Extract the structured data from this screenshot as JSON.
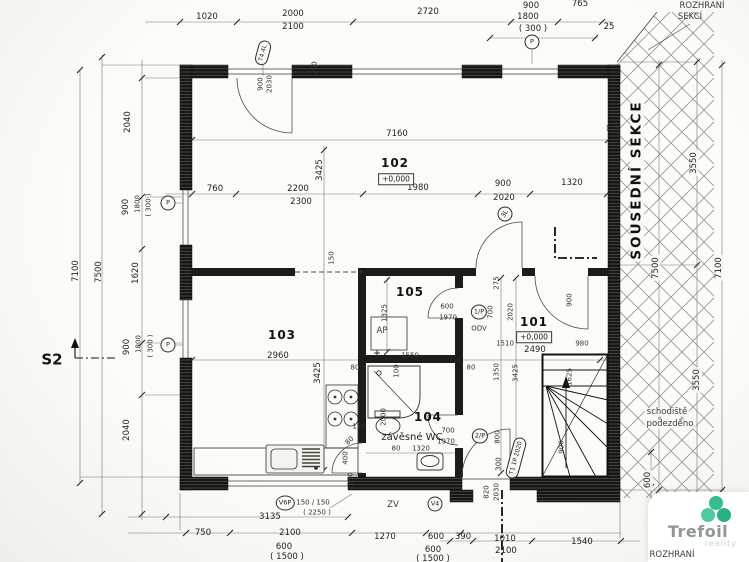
{
  "logo": {
    "name": "Trefoil",
    "tagline": "reality"
  },
  "rooms": [
    {
      "number": "102",
      "level": "+0,000",
      "x": 395,
      "y": 163,
      "lx": 396,
      "ly": 179
    },
    {
      "number": "103",
      "x": 282,
      "y": 335
    },
    {
      "number": "105",
      "x": 410,
      "y": 292
    },
    {
      "number": "104",
      "x": 428,
      "y": 417
    },
    {
      "number": "101",
      "level": "+0,000",
      "x": 534,
      "y": 322,
      "lx": 534,
      "ly": 337
    }
  ],
  "markers": [
    {
      "label": "P",
      "x": 532,
      "y": 42
    },
    {
      "label": "P",
      "x": 168,
      "y": 203
    },
    {
      "label": "P",
      "x": 168,
      "y": 345
    },
    {
      "label": "3L",
      "x": 505,
      "y": 214,
      "r": -60
    },
    {
      "label": "1/P",
      "x": 479,
      "y": 312
    },
    {
      "label": "2/P",
      "x": 480,
      "y": 436
    },
    {
      "label": "V6P",
      "x": 285,
      "y": 503
    },
    {
      "label": "V4",
      "x": 435,
      "y": 504
    },
    {
      "label": "T4.4L",
      "x": 263,
      "y": 53,
      "r": -75,
      "w": 1
    },
    {
      "label": "T1 1P 2020",
      "x": 516,
      "y": 458,
      "r": -75,
      "w": 1
    }
  ],
  "dim_labels": [
    {
      "t": "1020",
      "x": 207,
      "y": 17
    },
    {
      "t": "2000",
      "x": 293,
      "y": 14
    },
    {
      "t": "2100",
      "x": 293,
      "y": 27
    },
    {
      "t": "2720",
      "x": 428,
      "y": 12
    },
    {
      "t": "900",
      "x": 531,
      "y": 6
    },
    {
      "t": "765",
      "x": 580,
      "y": 4
    },
    {
      "t": "1800",
      "x": 528,
      "y": 17
    },
    {
      "t": "( 300 )",
      "x": 533,
      "y": 29
    },
    {
      "t": "25",
      "x": 609,
      "y": 27
    },
    {
      "t": "ROZHRANÍ",
      "x": 702,
      "y": 6,
      "c": "note"
    },
    {
      "t": "SEKCÍ",
      "x": 690,
      "y": 17,
      "c": "note"
    },
    {
      "t": "7160",
      "x": 397,
      "y": 134
    },
    {
      "t": "125",
      "x": 612,
      "y": 129,
      "c": "xs"
    },
    {
      "t": "3425",
      "x": 320,
      "y": 170,
      "r": -90
    },
    {
      "t": "900",
      "x": 261,
      "y": 84,
      "r": -90,
      "c": "xs"
    },
    {
      "t": "2030",
      "x": 270,
      "y": 84,
      "r": -90,
      "c": "xs"
    },
    {
      "t": "250",
      "x": 315,
      "y": 68,
      "r": -90,
      "c": "xs"
    },
    {
      "t": "760",
      "x": 215,
      "y": 189
    },
    {
      "t": "2200",
      "x": 298,
      "y": 189
    },
    {
      "t": "2300",
      "x": 301,
      "y": 202
    },
    {
      "t": "1980",
      "x": 418,
      "y": 188
    },
    {
      "t": "900",
      "x": 503,
      "y": 184
    },
    {
      "t": "2020",
      "x": 504,
      "y": 198
    },
    {
      "t": "1320",
      "x": 572,
      "y": 183
    },
    {
      "t": "150",
      "x": 332,
      "y": 258,
      "r": -90,
      "c": "xs"
    },
    {
      "t": "2960",
      "x": 278,
      "y": 356
    },
    {
      "t": "1325",
      "x": 385,
      "y": 313,
      "r": -90,
      "c": "xs"
    },
    {
      "t": "AP",
      "x": 382,
      "y": 331,
      "c": "note"
    },
    {
      "t": "600",
      "x": 447,
      "y": 307,
      "c": "xs"
    },
    {
      "t": "1970",
      "x": 448,
      "y": 318,
      "c": "xs"
    },
    {
      "t": "1550",
      "x": 410,
      "y": 356,
      "c": "xs"
    },
    {
      "t": "80",
      "x": 355,
      "y": 368,
      "c": "xs"
    },
    {
      "t": "100",
      "x": 397,
      "y": 371,
      "r": -90,
      "c": "xs"
    },
    {
      "t": "3425",
      "x": 318,
      "y": 373,
      "r": -90
    },
    {
      "t": "275",
      "x": 497,
      "y": 283,
      "r": -90,
      "c": "xs"
    },
    {
      "t": "700",
      "x": 491,
      "y": 312,
      "r": -90,
      "c": "xs"
    },
    {
      "t": "2020",
      "x": 511,
      "y": 312,
      "r": -90,
      "c": "xs"
    },
    {
      "t": "900",
      "x": 570,
      "y": 300,
      "r": -90,
      "c": "xs"
    },
    {
      "t": "ODV",
      "x": 479,
      "y": 329,
      "c": "xs"
    },
    {
      "t": "1510",
      "x": 505,
      "y": 344,
      "c": "xs"
    },
    {
      "t": "980",
      "x": 582,
      "y": 344,
      "c": "xs"
    },
    {
      "t": "2490",
      "x": 535,
      "y": 350
    },
    {
      "t": "1625",
      "x": 570,
      "y": 377,
      "r": -90,
      "c": "xs"
    },
    {
      "t": "1350",
      "x": 497,
      "y": 372,
      "r": -90,
      "c": "xs"
    },
    {
      "t": "3425",
      "x": 516,
      "y": 373,
      "r": -90,
      "c": "xs"
    },
    {
      "t": "80",
      "x": 471,
      "y": 368,
      "c": "xs"
    },
    {
      "t": "900",
      "x": 562,
      "y": 447,
      "r": -90,
      "c": "xs"
    },
    {
      "t": "2000",
      "x": 384,
      "y": 417,
      "r": -90,
      "c": "xs"
    },
    {
      "t": "150",
      "x": 359,
      "y": 427,
      "c": "xs"
    },
    {
      "t": "700",
      "x": 448,
      "y": 431,
      "c": "xs"
    },
    {
      "t": "1970",
      "x": 446,
      "y": 442,
      "c": "xs"
    },
    {
      "t": "800",
      "x": 498,
      "y": 437,
      "r": -90,
      "c": "xs"
    },
    {
      "t": "závěsné WC",
      "x": 412,
      "y": 438,
      "c": "wc"
    },
    {
      "t": "80",
      "x": 396,
      "y": 449,
      "c": "xs"
    },
    {
      "t": "1320",
      "x": 421,
      "y": 449,
      "c": "xs"
    },
    {
      "t": "80",
      "x": 350,
      "y": 441,
      "r": -45,
      "c": "xs"
    },
    {
      "t": "400",
      "x": 346,
      "y": 458,
      "r": -90,
      "c": "xs"
    },
    {
      "t": "250",
      "x": 351,
      "y": 479,
      "r": -90,
      "c": "xs"
    },
    {
      "t": "300",
      "x": 499,
      "y": 464,
      "r": -90,
      "c": "xs"
    },
    {
      "t": "820",
      "x": 487,
      "y": 492,
      "r": -90,
      "c": "xs"
    },
    {
      "t": "2030",
      "x": 497,
      "y": 492,
      "r": -90,
      "c": "xs"
    },
    {
      "t": "150 / 150",
      "x": 313,
      "y": 503,
      "c": "xs"
    },
    {
      "t": "( 2250 )",
      "x": 317,
      "y": 513,
      "c": "xs"
    },
    {
      "t": "ZV",
      "x": 393,
      "y": 505,
      "c": "note"
    },
    {
      "t": "3135",
      "x": 270,
      "y": 517
    },
    {
      "t": "750",
      "x": 203,
      "y": 533
    },
    {
      "t": "2100",
      "x": 290,
      "y": 533
    },
    {
      "t": "1270",
      "x": 385,
      "y": 537
    },
    {
      "t": "600",
      "x": 436,
      "y": 537
    },
    {
      "t": "600",
      "x": 284,
      "y": 547
    },
    {
      "t": "( 1500 )",
      "x": 287,
      "y": 557
    },
    {
      "t": "600",
      "x": 433,
      "y": 550
    },
    {
      "t": "( 1500 )",
      "x": 433,
      "y": 559
    },
    {
      "t": "390",
      "x": 463,
      "y": 537
    },
    {
      "t": "1010",
      "x": 505,
      "y": 539
    },
    {
      "t": "2100",
      "x": 506,
      "y": 551
    },
    {
      "t": "1540",
      "x": 582,
      "y": 542
    },
    {
      "t": "ROZHRANÍ",
      "x": 672,
      "y": 555,
      "c": "note"
    },
    {
      "t": "SOUSEDNÍ SEKCE",
      "x": 637,
      "y": 180,
      "r": -90,
      "c": "section halo"
    },
    {
      "t": "3550",
      "x": 694,
      "y": 163,
      "r": -90,
      "c": "halo"
    },
    {
      "t": "7500",
      "x": 656,
      "y": 268,
      "r": -90,
      "c": "halo"
    },
    {
      "t": "7100",
      "x": 719,
      "y": 268,
      "r": -90,
      "c": "halo"
    },
    {
      "t": "3550",
      "x": 697,
      "y": 380,
      "r": -90,
      "c": "halo"
    },
    {
      "t": "600",
      "x": 648,
      "y": 480,
      "r": -90,
      "c": "halo"
    },
    {
      "t": "schodiště",
      "x": 667,
      "y": 412,
      "c": "note halo"
    },
    {
      "t": "podezděno",
      "x": 670,
      "y": 424,
      "c": "note halo"
    },
    {
      "t": "7100",
      "x": 76,
      "y": 271,
      "r": -90
    },
    {
      "t": "7500",
      "x": 99,
      "y": 272,
      "r": -90
    },
    {
      "t": "2040",
      "x": 128,
      "y": 122,
      "r": -90
    },
    {
      "t": "900",
      "x": 126,
      "y": 207,
      "r": -90
    },
    {
      "t": "1800",
      "x": 138,
      "y": 204,
      "r": -90,
      "c": "xs"
    },
    {
      "t": "( 300 )",
      "x": 149,
      "y": 205,
      "r": -90,
      "c": "xs"
    },
    {
      "t": "1620",
      "x": 136,
      "y": 273,
      "r": -90
    },
    {
      "t": "900",
      "x": 127,
      "y": 347,
      "r": -90
    },
    {
      "t": "1800",
      "x": 139,
      "y": 344,
      "r": -90,
      "c": "xs"
    },
    {
      "t": "( 300 )",
      "x": 151,
      "y": 346,
      "r": -90,
      "c": "xs"
    },
    {
      "t": "2040",
      "x": 127,
      "y": 430,
      "r": -90
    },
    {
      "t": "S2",
      "x": 52,
      "y": 360,
      "c": "s2"
    }
  ]
}
